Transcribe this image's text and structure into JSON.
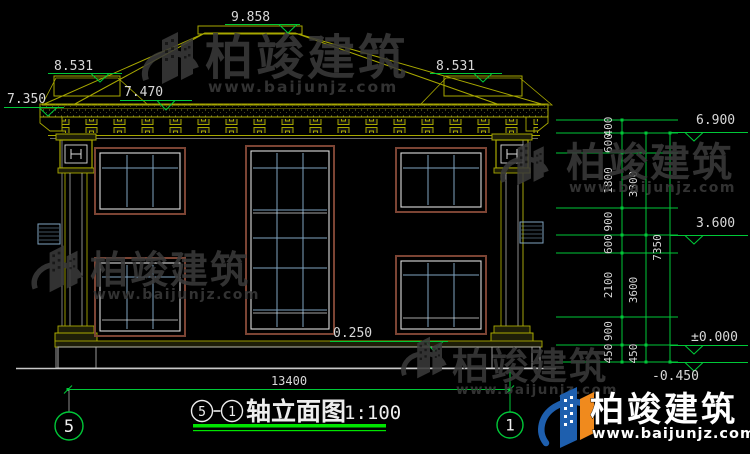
{
  "meta": {
    "drawing_type": "axis elevation drawing",
    "background": "#000000"
  },
  "colors": {
    "accent_green": "#00C838",
    "underline_green": "#00E400",
    "dim_text": "#D8D8D8",
    "trim_olive": "#A8A800",
    "frame_brown": "#7C4434",
    "frame_white": "#DCDCDC",
    "mullion_blue": "#7FA3C1",
    "stone_gray": "#BDBDBD",
    "tile_gray": "#8F9898",
    "watermark_gray": "#3A3A3A",
    "logo_blue": "#1E5FAE",
    "logo_orange": "#F08A1D"
  },
  "elevations": {
    "ridge": "9.858",
    "left_upper": "8.531",
    "right_upper": "8.531",
    "left_eave": "7.350",
    "slope": "7.470",
    "right_eave": "6.900",
    "second_floor": "3.600",
    "plinth": "0.250",
    "zero": "±0.000",
    "ground": "-0.450"
  },
  "dims": {
    "right_chain": [
      "400",
      "600",
      "1800",
      "900",
      "600",
      "2100",
      "900",
      "450"
    ],
    "right_totals": [
      "3300",
      "3600",
      "450"
    ],
    "right_overall": "7350",
    "bottom_overall": "13400"
  },
  "axes": {
    "left": "5",
    "right": "1"
  },
  "title": {
    "axis_from": "5",
    "axis_to": "1",
    "text": "轴立面图",
    "scale": "1:100"
  },
  "watermark": {
    "name": "柏竣建筑",
    "url": "www.baijunjz.com"
  },
  "logo": {
    "name": "柏竣建筑",
    "url": "www.baijunjz.com"
  }
}
